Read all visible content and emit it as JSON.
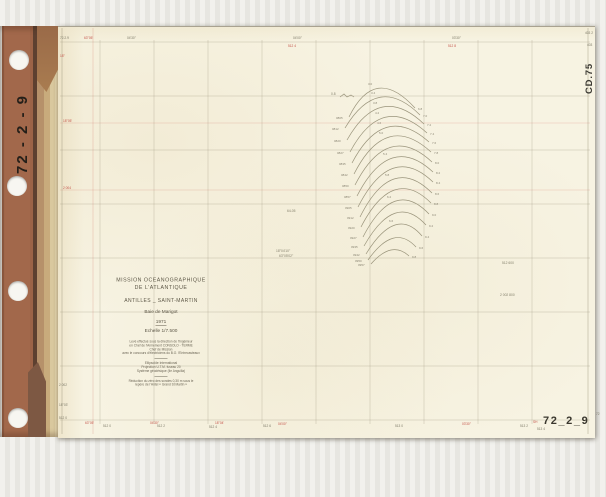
{
  "binder": {
    "spine_label": "72 - 2 - 9"
  },
  "sheet": {
    "code_top_right": "CD.75",
    "code_bottom_left": "CD.75",
    "number_bottom_right": "72_2_9",
    "title_block": {
      "line1": "MISSION  OCEANOGRAPHIQUE",
      "line2": "DE  L'ATLANTIQUE",
      "line3": "ANTILLES _ SAINT-MARTIN",
      "line4": "Baie  de  Marigot",
      "year": "1971",
      "scale": "Echelle  1/7.500",
      "credits": [
        "Levé effectué sous la direction de l'Ingénieur",
        "en Chef de l'Armement  CONSOLO - TERME",
        "Chef de Mission",
        "avec le concours d'électriciens du B.O. l'Entrecasteaux"
      ],
      "geodesy": [
        "Ellipsoïde  International",
        "Projection  U.T.M.  fuseau  20",
        "Système géodésique  (île  Anguilla)"
      ],
      "datum": [
        "Réduction du zéro des sondes  0,30 m  sous  le",
        "repère  de  l'Hôtel  « Grand  St  Martin »"
      ]
    }
  },
  "colors": {
    "paper": "#f7f3e2",
    "binder_brown": "#9c6347",
    "tape": "#c8ab7c",
    "grid_gray": "#948e74",
    "accent_red": "#c4544a",
    "ink": "#5d5747",
    "arc_line": "#9a947b"
  },
  "grid": {
    "v": [
      100,
      154,
      208,
      262,
      316,
      370,
      424,
      478,
      532
    ],
    "v_top": 40,
    "v_bottom": 424,
    "h": [
      42,
      96,
      150,
      204,
      258,
      312,
      366,
      420
    ],
    "h_left": 60,
    "h_right": 590,
    "borders": [
      {
        "x": 588,
        "y1": 28,
        "y2": 434
      },
      {
        "x": 62,
        "y1": 28,
        "y2": 434
      }
    ],
    "red_h": [
      123,
      190
    ],
    "red_v": [
      93
    ]
  },
  "fan": {
    "squiggle": "M340,97 l4,-3 l3,3 l4,-2 l3,2",
    "arcs": [
      {
        "d": "M349,117 Q375,64 415,108",
        "ll": "0805",
        "rl": "6.8",
        "al": "3.0",
        "ax": 368,
        "ay": 85
      },
      {
        "d": "M345,128 Q378,73 420,115",
        "ll": "0812",
        "rl": "7.0",
        "al": "3.4",
        "ax": 371,
        "ay": 94
      },
      {
        "d": "M347,140 Q380,82 424,124",
        "ll": "0820",
        "rl": "7.2",
        "al": "3.8",
        "ax": 373,
        "ay": 104
      },
      {
        "d": "M350,152 Q382,92 427,133",
        "ll": "0827",
        "rl": "7.4",
        "al": "4.2",
        "ax": 375,
        "ay": 114
      },
      {
        "d": "M352,163 Q384,102 429,142",
        "ll": "0835",
        "rl": "7.6",
        "al": "4.6",
        "ax": 377,
        "ay": 124
      },
      {
        "d": "M354,174 Q386,111 431,152",
        "ll": "0842",
        "rl": "7.8",
        "al": "5.0",
        "ax": 379,
        "ay": 134
      },
      {
        "d": "M355,185 Q388,121 432,162",
        "ll": "0850",
        "rl": "8.0"
      },
      {
        "d": "M357,196 Q390,132 433,172",
        "ll": "0857",
        "rl": "8.2",
        "al": "5.4",
        "ax": 383,
        "ay": 155
      },
      {
        "d": "M358,207 Q391,142 433,182",
        "ll": "0905",
        "rl": "8.4"
      },
      {
        "d": "M360,217 Q392,153 432,193",
        "ll": "0912",
        "rl": "8.6",
        "al": "5.8",
        "ax": 385,
        "ay": 176
      },
      {
        "d": "M361,227 Q393,165 431,203",
        "ll": "0920",
        "rl": "8.8"
      },
      {
        "d": "M363,237 Q394,177 429,214",
        "ll": "0927",
        "rl": "9.0",
        "al": "6.2",
        "ax": 387,
        "ay": 198
      },
      {
        "d": "M364,246 Q395,191 426,225",
        "ll": "0935",
        "rl": "9.2"
      },
      {
        "d": "M366,254 Q396,205 422,236",
        "ll": "0942",
        "rl": "9.4",
        "al": "6.6",
        "ax": 389,
        "ay": 222
      },
      {
        "d": "M368,260 Q394,223 416,247",
        "ll": "0950",
        "rl": "9.6"
      },
      {
        "d": "M371,264 Q392,240 409,256",
        "ll": "0957",
        "rl": "9.8"
      }
    ]
  },
  "ticks": [
    {
      "x": 84,
      "y": 39,
      "t": "63°05'",
      "c": "r"
    },
    {
      "x": 127,
      "y": 39,
      "t": "04'30''",
      "c": "g"
    },
    {
      "x": 293,
      "y": 39,
      "t": "04'00''",
      "c": "g"
    },
    {
      "x": 288,
      "y": 47,
      "t": "512 4",
      "c": "r"
    },
    {
      "x": 452,
      "y": 39,
      "t": "03'30''",
      "c": "g"
    },
    {
      "x": 448,
      "y": 47,
      "t": "512 8",
      "c": "r"
    },
    {
      "x": 585,
      "y": 34,
      "t": "403 2",
      "c": "g"
    },
    {
      "x": 587,
      "y": 46,
      "t": "403",
      "c": "g"
    },
    {
      "x": 63,
      "y": 122,
      "t": "18°05'",
      "c": "r"
    },
    {
      "x": 63,
      "y": 189,
      "t": "2 004",
      "c": "r"
    },
    {
      "x": 60,
      "y": 39,
      "t": "72.2.9",
      "c": "g"
    },
    {
      "x": 60,
      "y": 57,
      "t": "18°",
      "c": "r"
    },
    {
      "x": 85,
      "y": 424,
      "t": "63°05'",
      "c": "r"
    },
    {
      "x": 103,
      "y": 427,
      "t": "512 0",
      "c": "g"
    },
    {
      "x": 150,
      "y": 424,
      "t": "04'30''",
      "c": "r"
    },
    {
      "x": 157,
      "y": 427,
      "t": "512 2",
      "c": "g"
    },
    {
      "x": 215,
      "y": 424,
      "t": "18°04'",
      "c": "r"
    },
    {
      "x": 209,
      "y": 428,
      "t": "512 4",
      "c": "g"
    },
    {
      "x": 263,
      "y": 427,
      "t": "512 6",
      "c": "g"
    },
    {
      "x": 278,
      "y": 425,
      "t": "04'00''",
      "c": "r"
    },
    {
      "x": 395,
      "y": 427,
      "t": "513 0",
      "c": "g"
    },
    {
      "x": 462,
      "y": 425,
      "t": "03'30''",
      "c": "r"
    },
    {
      "x": 520,
      "y": 427,
      "t": "513 2",
      "c": "g"
    },
    {
      "x": 596,
      "y": 415,
      "t": "72",
      "c": "g"
    },
    {
      "x": 533,
      "y": 423,
      "t": "SH",
      "c": "r"
    },
    {
      "x": 537,
      "y": 430,
      "t": "513 4",
      "c": "g"
    },
    {
      "x": 59,
      "y": 386,
      "t": "2 002",
      "c": "g"
    },
    {
      "x": 59,
      "y": 406,
      "t": "18°03'",
      "c": "g"
    },
    {
      "x": 59,
      "y": 419,
      "t": "512 0",
      "c": "g"
    }
  ],
  "annotations": [
    {
      "x": 287,
      "y": 212,
      "t": "64-05"
    },
    {
      "x": 276,
      "y": 252,
      "t": "18°04'10''"
    },
    {
      "x": 279,
      "y": 257,
      "t": "63°05'02''"
    },
    {
      "x": 502,
      "y": 264,
      "t": "512 600"
    },
    {
      "x": 500,
      "y": 296,
      "t": "2 002 800"
    },
    {
      "x": 331,
      "y": 95,
      "t": "0.8"
    }
  ]
}
